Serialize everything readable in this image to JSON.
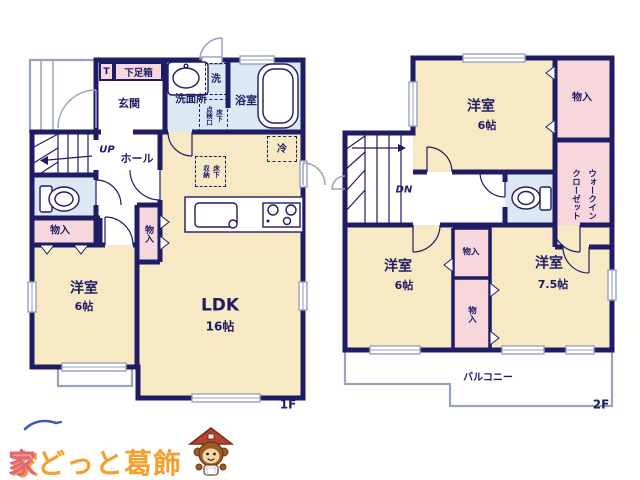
{
  "f1": {
    "floor_label": "1F",
    "entrance": "玄関",
    "toilet_mark": "T",
    "shoe_box": "下足箱",
    "washroom": "洗面所",
    "laundry": "洗",
    "inspection_col_a": "床下",
    "inspection_col_b": "点検口",
    "bathroom": "浴室",
    "up": "UP",
    "hall": "ホール",
    "storage_a": "物入",
    "storage_b": "物入",
    "bedroom": "洋室",
    "bedroom_size": "6帖",
    "ldk": "LDK",
    "ldk_size": "16帖",
    "fridge": "冷",
    "underfloor_col_a": "床下",
    "underfloor_col_b": "収納"
  },
  "f2": {
    "floor_label": "2F",
    "bedroom_top": "洋室",
    "bedroom_top_size": "6帖",
    "storage_top": "物入",
    "wic_col_a": "ウォークイン",
    "wic_col_b": "クローゼット",
    "dn": "DN",
    "bedroom_left": "洋室",
    "bedroom_left_size": "6帖",
    "storage_mid_a": "物入",
    "storage_mid_b": "物入",
    "bedroom_right": "洋室",
    "bedroom_right_size": "7.5帖",
    "balcony": "バルコニー"
  },
  "logo": {
    "text_a": "家",
    "text_b": "どっと",
    "text_c": "葛飾"
  },
  "colors": {
    "wall": "#1e1c64",
    "room": "#f8e9c5",
    "storage": "#f7d7dc",
    "wet": "#dce8f4",
    "line": "#9aa3bd",
    "logo-orange": "#f5a02d",
    "logo-pink": "#e0618e",
    "logo-blue": "#3f57b8",
    "mascot-brown": "#9c5a24",
    "mascot-roof": "#b5432e"
  }
}
